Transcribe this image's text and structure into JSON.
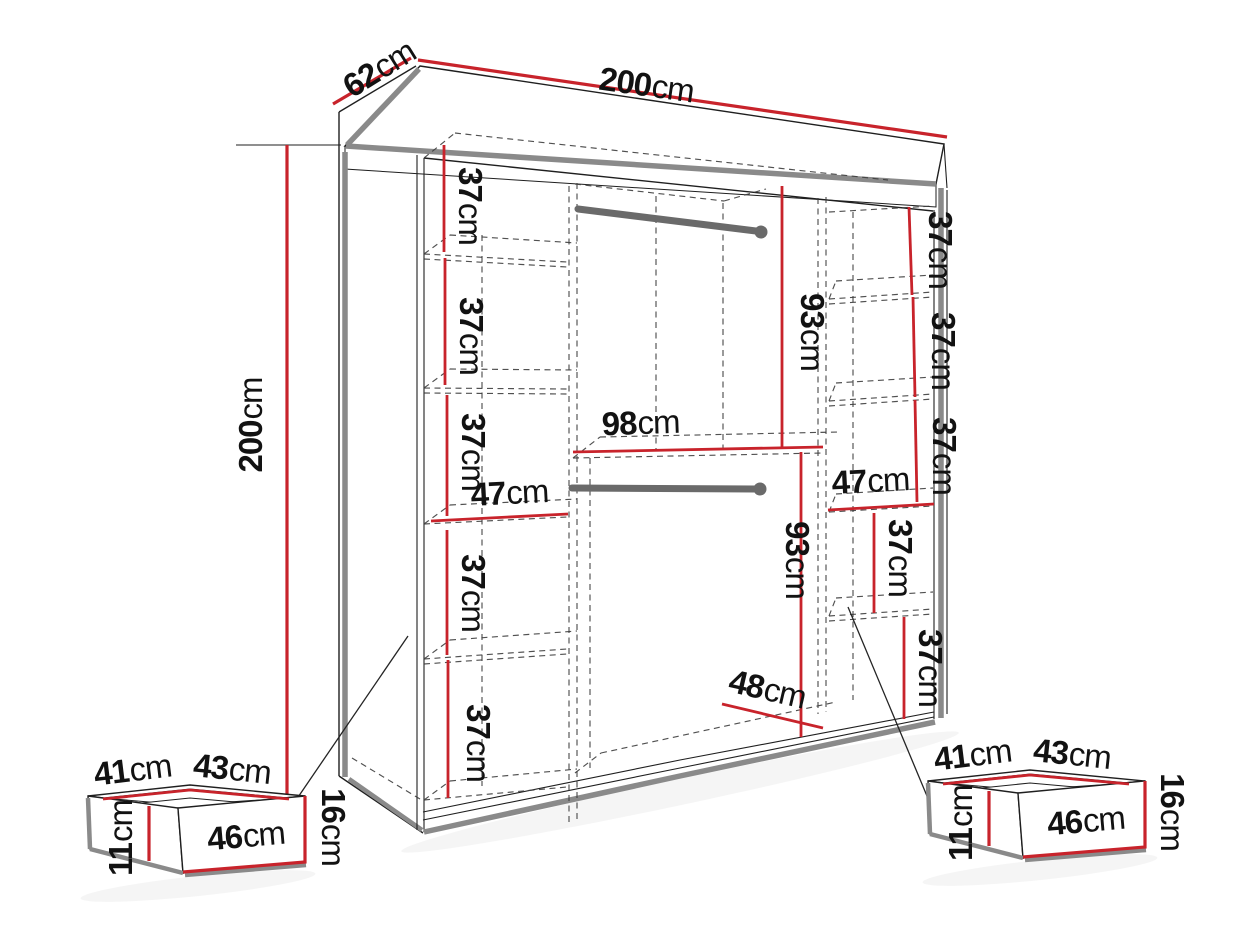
{
  "diagram": {
    "kind": "furniture-dimension-diagram",
    "subject": "sliding-door wardrobe with shelf columns, two hanging rails and two under-bed drawers",
    "units": "cm"
  },
  "colors": {
    "dimension_red": "#c8232b",
    "outline_black": "#1f1f1f",
    "panel_gray": "#8a8a8a",
    "rail_gray": "#6a6a6a",
    "background": "#ffffff"
  },
  "wardrobe": {
    "width": {
      "value": "200",
      "unit": "cm"
    },
    "depth": {
      "value": "62",
      "unit": "cm"
    },
    "height": {
      "value": "200",
      "unit": "cm"
    },
    "left_column": {
      "width": {
        "value": "47",
        "unit": "cm"
      },
      "shelf_heights": [
        {
          "value": "37",
          "unit": "cm"
        },
        {
          "value": "37",
          "unit": "cm"
        },
        {
          "value": "37",
          "unit": "cm"
        },
        {
          "value": "37",
          "unit": "cm"
        },
        {
          "value": "37",
          "unit": "cm"
        }
      ]
    },
    "middle_section": {
      "width": {
        "value": "98",
        "unit": "cm"
      },
      "upper_height": {
        "value": "93",
        "unit": "cm"
      },
      "lower_height": {
        "value": "93",
        "unit": "cm"
      },
      "bottom_depth": {
        "value": "48",
        "unit": "cm"
      },
      "hanging_rails": 2
    },
    "right_column": {
      "width": {
        "value": "47",
        "unit": "cm"
      },
      "shelf_heights": [
        {
          "value": "37",
          "unit": "cm"
        },
        {
          "value": "37",
          "unit": "cm"
        },
        {
          "value": "37",
          "unit": "cm"
        },
        {
          "value": "37",
          "unit": "cm"
        },
        {
          "value": "37",
          "unit": "cm"
        }
      ]
    }
  },
  "drawers": {
    "left": {
      "top_left_edge": {
        "value": "41",
        "unit": "cm"
      },
      "top_right_edge": {
        "value": "43",
        "unit": "cm"
      },
      "inner_height": {
        "value": "11",
        "unit": "cm"
      },
      "front_width": {
        "value": "46",
        "unit": "cm"
      },
      "front_height": {
        "value": "16",
        "unit": "cm"
      }
    },
    "right": {
      "top_left_edge": {
        "value": "41",
        "unit": "cm"
      },
      "top_right_edge": {
        "value": "43",
        "unit": "cm"
      },
      "inner_height": {
        "value": "11",
        "unit": "cm"
      },
      "front_width": {
        "value": "46",
        "unit": "cm"
      },
      "front_height": {
        "value": "16",
        "unit": "cm"
      }
    }
  }
}
